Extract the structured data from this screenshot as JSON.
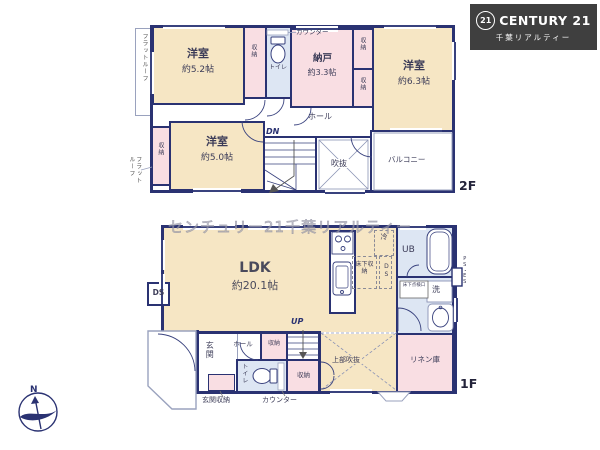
{
  "logo": {
    "badge": "21",
    "brand": "CENTURY 21",
    "company": "千葉リアルティー"
  },
  "watermark": "センチュリー21千葉リアルティー",
  "compass": {
    "north": "N"
  },
  "common": {
    "closet": "収納",
    "toilet": "トイレ",
    "hall": "ホール",
    "counter": "カウンター",
    "ds": "DS"
  },
  "floor2": {
    "label": "2F",
    "dn": "DN",
    "flat_roof": "フラットルーフ",
    "flat_roof_l1": "フラット",
    "flat_roof_l2": "ルーフ",
    "room52_name": "洋室",
    "room52_size": "約5.2帖",
    "room63_name": "洋室",
    "room63_size": "約6.3帖",
    "room50_name": "洋室",
    "room50_size": "約5.0帖",
    "nando_name": "納戸",
    "nando_size": "約3.3帖",
    "void": "吹抜",
    "balcony": "バルコニー"
  },
  "floor1": {
    "label": "1F",
    "up": "UP",
    "ldk_name": "LDK",
    "ldk_size": "約20.1帖",
    "genkan": "玄関",
    "genkan_storage": "玄関収納",
    "upper_void": "上部吹抜",
    "linen": "リネン庫",
    "unit_bath": "UB",
    "refrigerator": "冷",
    "underfloor_storage": "床下収納",
    "underfloor_hatch": "床下点検口",
    "wash": "洗",
    "pipe_space": "PS・ES"
  }
}
